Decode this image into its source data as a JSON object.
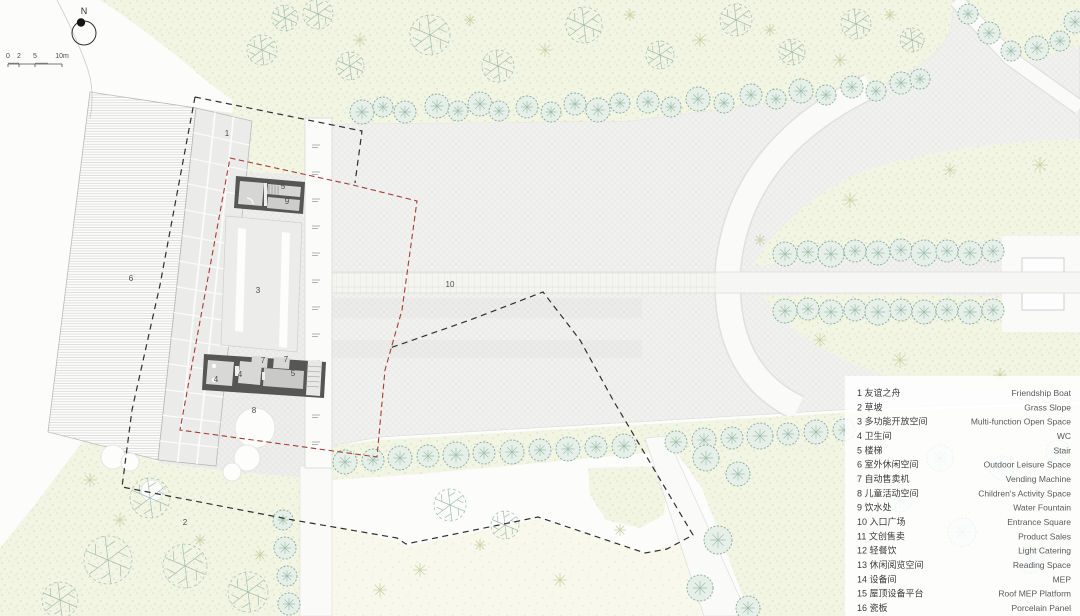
{
  "plan": {
    "north_label": "N",
    "scale_labels": [
      "0",
      "2",
      "5",
      "10m"
    ],
    "labels": [
      {
        "id": "friendship-boat",
        "t": "1",
        "x": 227,
        "y": 136
      },
      {
        "id": "grass-slope",
        "t": "2",
        "x": 185,
        "y": 525
      },
      {
        "id": "multi-function",
        "t": "3",
        "x": 258,
        "y": 293
      },
      {
        "id": "wc-left",
        "t": "4",
        "x": 216,
        "y": 382
      },
      {
        "id": "wc-right",
        "t": "4",
        "x": 240,
        "y": 377
      },
      {
        "id": "stair-top",
        "t": "5",
        "x": 283,
        "y": 189
      },
      {
        "id": "stair-lower",
        "t": "5",
        "x": 293,
        "y": 376
      },
      {
        "id": "outdoor-leisure",
        "t": "6",
        "x": 131,
        "y": 281
      },
      {
        "id": "vending-1",
        "t": "7",
        "x": 263,
        "y": 363
      },
      {
        "id": "vending-2",
        "t": "7",
        "x": 286,
        "y": 362
      },
      {
        "id": "children-space",
        "t": "8",
        "x": 254,
        "y": 413
      },
      {
        "id": "water-fountain",
        "t": "9",
        "x": 287,
        "y": 204
      },
      {
        "id": "entrance-square",
        "t": "10",
        "x": 450,
        "y": 287
      }
    ]
  },
  "legend": {
    "items": [
      {
        "num": "1",
        "zh": "友谊之舟",
        "en": "Friendship Boat"
      },
      {
        "num": "2",
        "zh": "草坡",
        "en": "Grass Slope"
      },
      {
        "num": "3",
        "zh": "多功能开放空间",
        "en": "Multi-function Open Space"
      },
      {
        "num": "4",
        "zh": "卫生间",
        "en": "WC"
      },
      {
        "num": "5",
        "zh": "楼梯",
        "en": "Stair"
      },
      {
        "num": "6",
        "zh": "室外休闲空间",
        "en": "Outdoor Leisure Space"
      },
      {
        "num": "7",
        "zh": "自动售卖机",
        "en": "Vending Machine"
      },
      {
        "num": "8",
        "zh": "儿童活动空间",
        "en": "Children's Activity Space"
      },
      {
        "num": "9",
        "zh": "饮水处",
        "en": "Water Fountain"
      },
      {
        "num": "10",
        "zh": "入口广场",
        "en": "Entrance Square"
      },
      {
        "num": "11",
        "zh": "文创售卖",
        "en": "Product Sales"
      },
      {
        "num": "12",
        "zh": "轻餐饮",
        "en": "Light Catering"
      },
      {
        "num": "13",
        "zh": "休闲阅览空间",
        "en": "Reading Space"
      },
      {
        "num": "14",
        "zh": "设备间",
        "en": "MEP"
      },
      {
        "num": "15",
        "zh": "屋顶设备平台",
        "en": "Roof MEP Platform"
      },
      {
        "num": "16",
        "zh": "瓷板",
        "en": "Porcelain Panel"
      }
    ]
  },
  "colors": {
    "site_boundary_black": "#2f2f2d",
    "design_scope_red": "#a63d33",
    "tree_green": "#84a99b",
    "planting_fill": "#f3f5e4",
    "plaza_gray": "#f1f1ef",
    "building_wall": "#565654"
  }
}
